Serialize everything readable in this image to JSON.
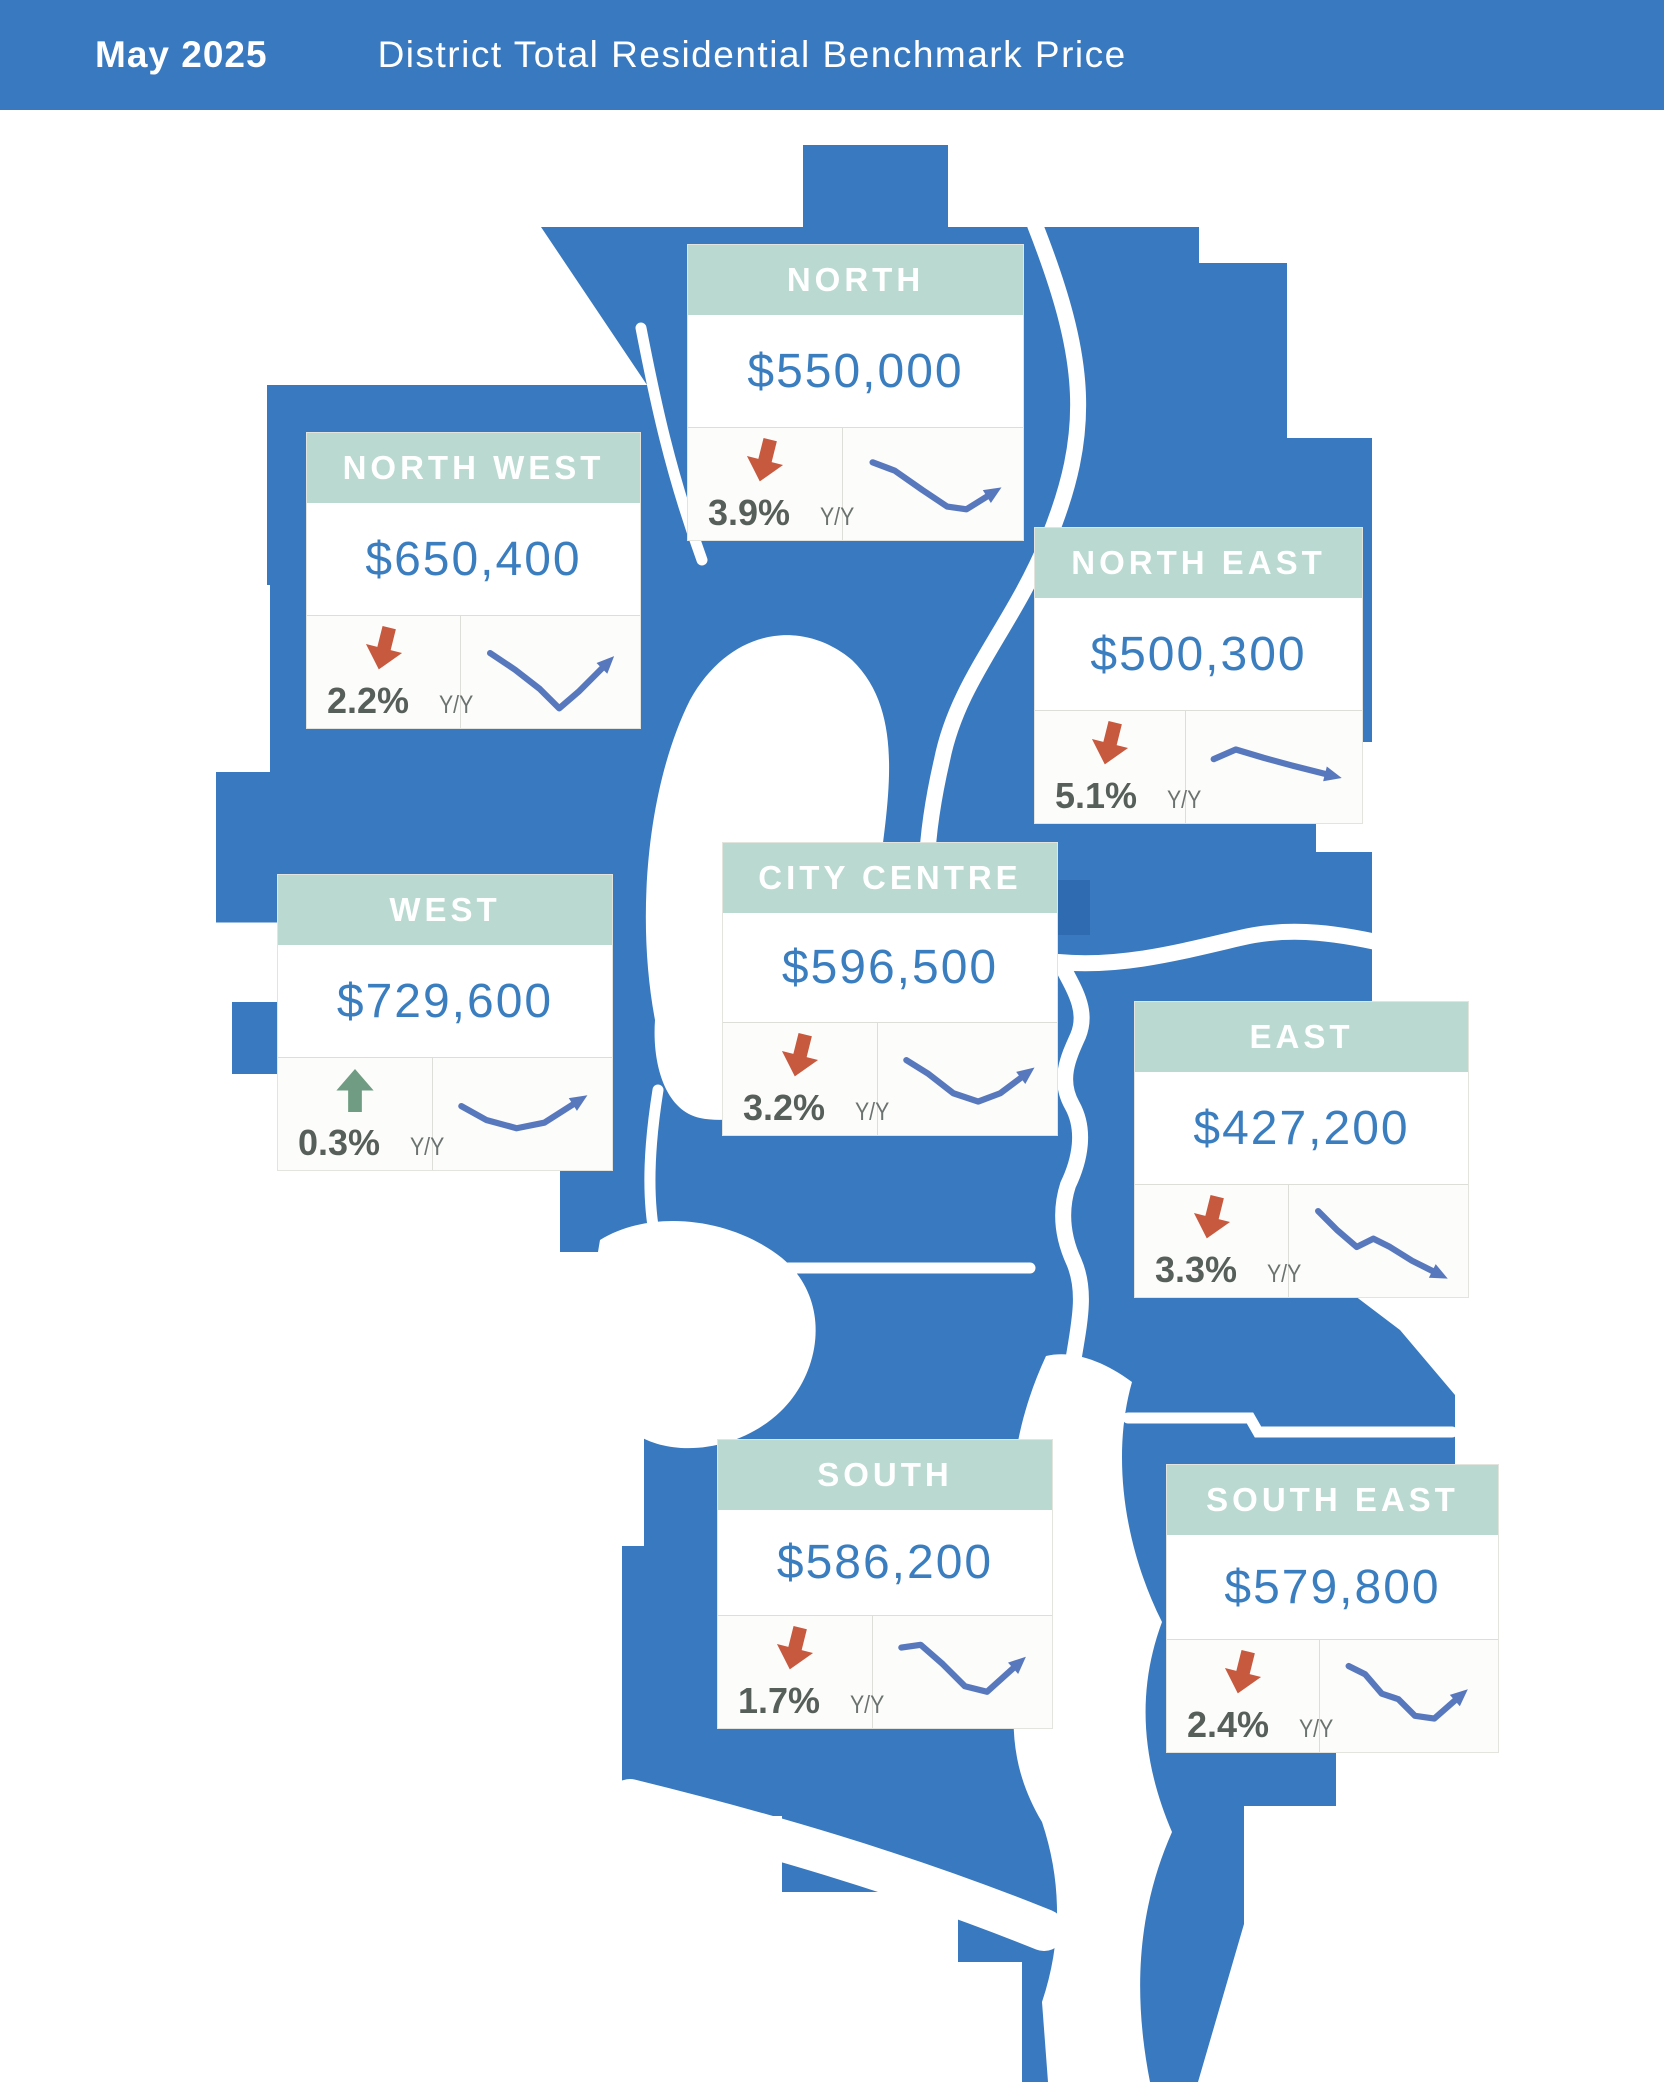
{
  "header": {
    "date_label": "May 2025",
    "title": "District Total Residential Benchmark Price"
  },
  "colors": {
    "header_bar_blue": "#3879C0",
    "map_blue": "#3879C0",
    "card_header_green": "#B9D9D1",
    "price_blue": "#3B7EC0",
    "down_arrow_red": "#C7593F",
    "up_arrow_green": "#6F9C82",
    "sparkline_blue": "#5878BE",
    "percent_gray": "#575F5A",
    "yoy_gray": "#6B7370"
  },
  "districts": [
    {
      "id": "north",
      "name": "NORTH",
      "price": "$550,000",
      "yoy_change": "3.9%",
      "direction": "down",
      "yoy_label": "Y/Y",
      "sparkline": [
        [
          6,
          14
        ],
        [
          22,
          20
        ],
        [
          42,
          34
        ],
        [
          60,
          46
        ],
        [
          74,
          48
        ],
        [
          90,
          38
        ]
      ],
      "position": {
        "left": 688,
        "top": 245,
        "width": 335,
        "height": 295
      }
    },
    {
      "id": "north-west",
      "name": "NORTH WEST",
      "price": "$650,400",
      "yoy_change": "2.2%",
      "direction": "down",
      "yoy_label": "Y/Y",
      "sparkline": [
        [
          6,
          16
        ],
        [
          24,
          28
        ],
        [
          42,
          42
        ],
        [
          56,
          56
        ],
        [
          70,
          44
        ],
        [
          88,
          26
        ]
      ],
      "position": {
        "left": 307,
        "top": 433,
        "width": 333,
        "height": 295
      }
    },
    {
      "id": "north-east",
      "name": "NORTH EAST",
      "price": "$500,300",
      "yoy_change": "5.1%",
      "direction": "down",
      "yoy_label": "Y/Y",
      "sparkline": [
        [
          6,
          24
        ],
        [
          22,
          17
        ],
        [
          42,
          23
        ],
        [
          64,
          29
        ],
        [
          88,
          35
        ]
      ],
      "position": {
        "left": 1035,
        "top": 528,
        "width": 327,
        "height": 295
      }
    },
    {
      "id": "west",
      "name": "WEST",
      "price": "$729,600",
      "yoy_change": "0.3%",
      "direction": "up",
      "yoy_label": "Y/Y",
      "sparkline": [
        [
          6,
          24
        ],
        [
          24,
          34
        ],
        [
          46,
          40
        ],
        [
          66,
          36
        ],
        [
          88,
          22
        ]
      ],
      "position": {
        "left": 278,
        "top": 875,
        "width": 334,
        "height": 295
      }
    },
    {
      "id": "city-centre",
      "name": "CITY CENTRE",
      "price": "$596,500",
      "yoy_change": "3.2%",
      "direction": "down",
      "yoy_label": "Y/Y",
      "sparkline": [
        [
          6,
          16
        ],
        [
          22,
          26
        ],
        [
          40,
          40
        ],
        [
          58,
          46
        ],
        [
          74,
          40
        ],
        [
          90,
          28
        ]
      ],
      "position": {
        "left": 723,
        "top": 843,
        "width": 334,
        "height": 292
      }
    },
    {
      "id": "east",
      "name": "EAST",
      "price": "$427,200",
      "yoy_change": "3.3%",
      "direction": "down",
      "yoy_label": "Y/Y",
      "sparkline": [
        [
          6,
          8
        ],
        [
          20,
          22
        ],
        [
          34,
          34
        ],
        [
          46,
          28
        ],
        [
          58,
          34
        ],
        [
          74,
          44
        ],
        [
          90,
          52
        ]
      ],
      "position": {
        "left": 1135,
        "top": 1002,
        "width": 333,
        "height": 295
      }
    },
    {
      "id": "south",
      "name": "SOUTH",
      "price": "$586,200",
      "yoy_change": "1.7%",
      "direction": "down",
      "yoy_label": "Y/Y",
      "sparkline": [
        [
          6,
          12
        ],
        [
          20,
          10
        ],
        [
          36,
          24
        ],
        [
          52,
          40
        ],
        [
          68,
          44
        ],
        [
          88,
          26
        ]
      ],
      "position": {
        "left": 718,
        "top": 1440,
        "width": 334,
        "height": 288
      }
    },
    {
      "id": "south-east",
      "name": "SOUTH EAST",
      "price": "$579,800",
      "yoy_change": "2.4%",
      "direction": "down",
      "yoy_label": "Y/Y",
      "sparkline": [
        [
          6,
          8
        ],
        [
          18,
          14
        ],
        [
          30,
          28
        ],
        [
          42,
          32
        ],
        [
          54,
          44
        ],
        [
          68,
          46
        ],
        [
          84,
          32
        ]
      ],
      "position": {
        "left": 1167,
        "top": 1465,
        "width": 331,
        "height": 287
      }
    }
  ],
  "arrow_glyphs": {
    "down": "M14,2 L28,2 L28,24 L40,24 L21,46 L2,24 L14,24 Z",
    "up": "M21,2 L40,24 L28,24 L28,46 L14,46 L14,24 L2,24 Z"
  }
}
